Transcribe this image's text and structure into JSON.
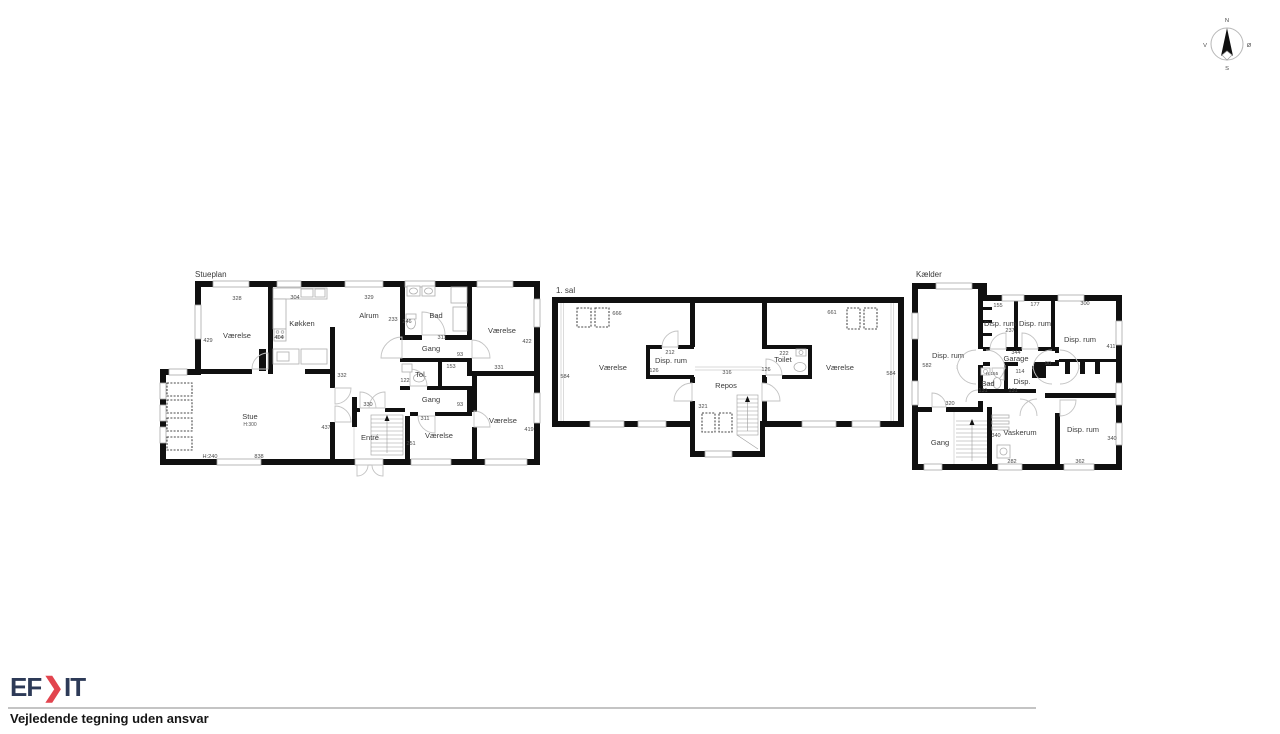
{
  "compass": {
    "north": "N",
    "south": "S",
    "west": "V",
    "east": "Ø"
  },
  "footer": {
    "brand_prefix": "EF",
    "brand_chevron": "❯",
    "brand_suffix": "IT",
    "disclaimer": "Vejledende tegning uden ansvar",
    "brand_color": "#2d3a57",
    "accent_color": "#e2444e"
  },
  "stueplan": {
    "title": "Stueplan",
    "rooms": {
      "vaerelse_tl": "Værelse",
      "kokken": "Køkken",
      "alrum": "Alrum",
      "bad": "Bad",
      "vaerelse_tr": "Værelse",
      "gang1": "Gang",
      "tol": "Tol.",
      "gang2": "Gang",
      "stue": "Stue",
      "stue_height": "H:300",
      "entre": "Entré",
      "vaerelse_bm": "Værelse",
      "vaerelse_br": "Værelse"
    },
    "dims": {
      "top_vaerelse": "328",
      "top_kokken": "304",
      "top_alrum": "329",
      "left_vaerelse": "429",
      "kokken_left": "404",
      "alrum_right": "233",
      "alrum_bottom": "332",
      "bad_left": "246",
      "bad_bottom": "311",
      "vaerelse_tr_right": "422",
      "gang1_width": "93",
      "tol_width": "153",
      "tol_left": "122",
      "vaerelse_tr_bottom": "331",
      "gang2_width": "93",
      "entre_top": "330",
      "gang2_bottom": "311",
      "stue_right": "437",
      "stairs": "251",
      "vaerelse_br_right": "419",
      "stue_height_note": "H:240",
      "stue_bottom": "838"
    }
  },
  "firstfloor": {
    "title": "1. sal",
    "rooms": {
      "vaerelse_l": "Værelse",
      "disp_rum": "Disp. rum",
      "repos": "Repos",
      "toilet": "Toilet",
      "vaerelse_r": "Værelse"
    },
    "dims": {
      "vaerelse_l_top": "666",
      "vaerelse_l_left": "584",
      "disp_top": "212",
      "disp_left": "126",
      "repos_width": "316",
      "repos_left": "321",
      "toilet_top": "222",
      "toilet_left": "126",
      "vaerelse_r_top": "661",
      "vaerelse_r_right": "584"
    }
  },
  "basement": {
    "title": "Kælder",
    "rooms": {
      "disp_l": "Disp. rum",
      "disp_a": "Disp. rum",
      "disp_b": "Disp. rum",
      "disp_r": "Disp. rum",
      "garage": "Garage",
      "bad": "Bad",
      "disp_small": "Disp.",
      "gang": "Gang",
      "vaskerum": "Vaskerum",
      "disp_br": "Disp. rum"
    },
    "dims": {
      "disp_l_left": "582",
      "disp_a_top": "155",
      "disp_a_inner": "237",
      "disp_b_top": "177",
      "disp_r_top": "300",
      "disp_r_right": "411",
      "garage_width": "344",
      "garage_right": "90",
      "bad_height": "H:155",
      "bad_left": "131",
      "disp_small_top": "114",
      "disp_small_left": "131",
      "gang_top": "320",
      "vaskerum_left": "340",
      "vaskerum_bottom": "282",
      "disp_br_right": "340",
      "disp_br_bottom": "362"
    }
  }
}
